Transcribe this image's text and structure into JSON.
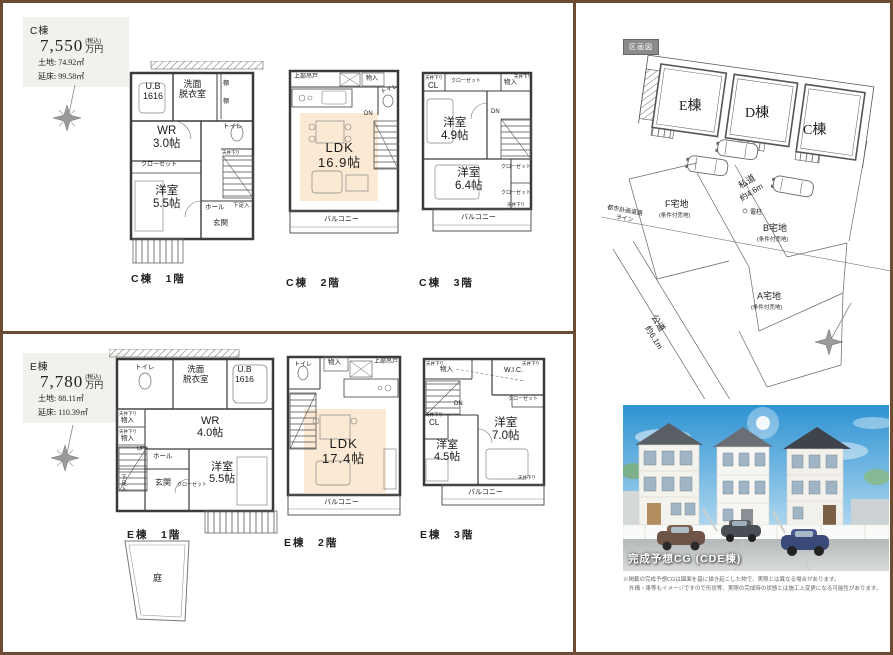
{
  "unit_c": {
    "name": "C棟",
    "price": "7,550",
    "tax": "(税込)",
    "yen": "万円",
    "land": "土地: 74.92㎡",
    "gross": "延床: 99.58㎡"
  },
  "unit_e": {
    "name": "E棟",
    "price": "7,780",
    "tax": "(税込)",
    "yen": "万円",
    "land": "土地: 88.11㎡",
    "gross": "延床: 110.39㎡"
  },
  "captions": {
    "c1": "C棟　1階",
    "c2": "C棟　2階",
    "c3": "C棟　3階",
    "e1": "E棟　1階",
    "e2": "E棟　2階",
    "e3": "E棟　3階"
  },
  "c1": {
    "ub": "U.B\n1616",
    "wash": "洗面\n脱衣室",
    "shelf1": "棚",
    "shelf2": "棚",
    "toilet": "トイレ",
    "ceil": "天井下り",
    "wr": "WR\n3.0帖",
    "closet": "クローゼット",
    "bed": "洋室\n5.5帖",
    "hall": "ホール",
    "shoe": "下足入",
    "entry": "玄関"
  },
  "c2": {
    "hang": "上部吊戸",
    "storage": "物入",
    "toilet": "トイレ",
    "dn": "DN",
    "ldk": "LDK\n16.9帖",
    "balcony": "バルコニー"
  },
  "c3": {
    "ceil1": "天井下り",
    "cl": "CL",
    "closet_top": "クローゼット",
    "storage": "物入",
    "ceil2": "天井下り",
    "bed1": "洋室\n4.9帖",
    "dn": "DN",
    "bed2": "洋室\n6.4帖",
    "closet_r1": "クローゼット",
    "closet_r2": "クローゼット",
    "ceil3": "天井下り",
    "balcony": "バルコニー"
  },
  "e1": {
    "toilet": "トイレ",
    "wash": "洗面\n脱衣室",
    "ub": "U.B\n1616",
    "ceil1": "天井下り",
    "st1": "物入",
    "ceil2": "天井下り",
    "st2": "物入",
    "wr": "WR\n4.0帖",
    "up": "UP",
    "hall": "ホール",
    "shoe": "下足入",
    "entry": "玄関",
    "closet": "クローゼット",
    "bed": "洋室\n5.5帖",
    "garden": "庭"
  },
  "e2": {
    "toilet": "トイレ",
    "storage": "物入",
    "hang": "上部吊戸",
    "ldk": "LDK\n17.4帖",
    "balcony": "バルコニー"
  },
  "e3": {
    "ceil1": "天井下り",
    "storage": "物入",
    "wic": "W.I.C.",
    "ceil2": "天井下り",
    "closet": "クローゼット",
    "dn": "DN",
    "ceil3": "天井下り",
    "cl": "CL",
    "bed1": "洋室\n4.5帖",
    "bed2": "洋室\n7.0帖",
    "ceil4": "天井下り",
    "balcony": "バルコニー"
  },
  "siteplan": {
    "tag": "区画図",
    "b_e": "E棟",
    "b_d": "D棟",
    "b_c": "C棟",
    "shidou": "私道",
    "shidou_w": "約4.6m",
    "koudou": "公道",
    "koudou_w": "約6.1m",
    "plot_f": "F宅地",
    "plot_b": "B宅地",
    "plot_a": "A宅地",
    "cond": "(条件付売地)",
    "planline1": "都市計画道路",
    "planline2": "ライン",
    "pole": "電柱"
  },
  "cg": {
    "caption": "完成予想CG (CDE棟)",
    "note1": "※掲載の完成予想CGは図面を基に描き起こした物で、実際とは異なる場合があります。",
    "note2": "外構・車等もイメージですので形状等、実際の完成時の状態とは施工上変更になる可能性があります。"
  }
}
